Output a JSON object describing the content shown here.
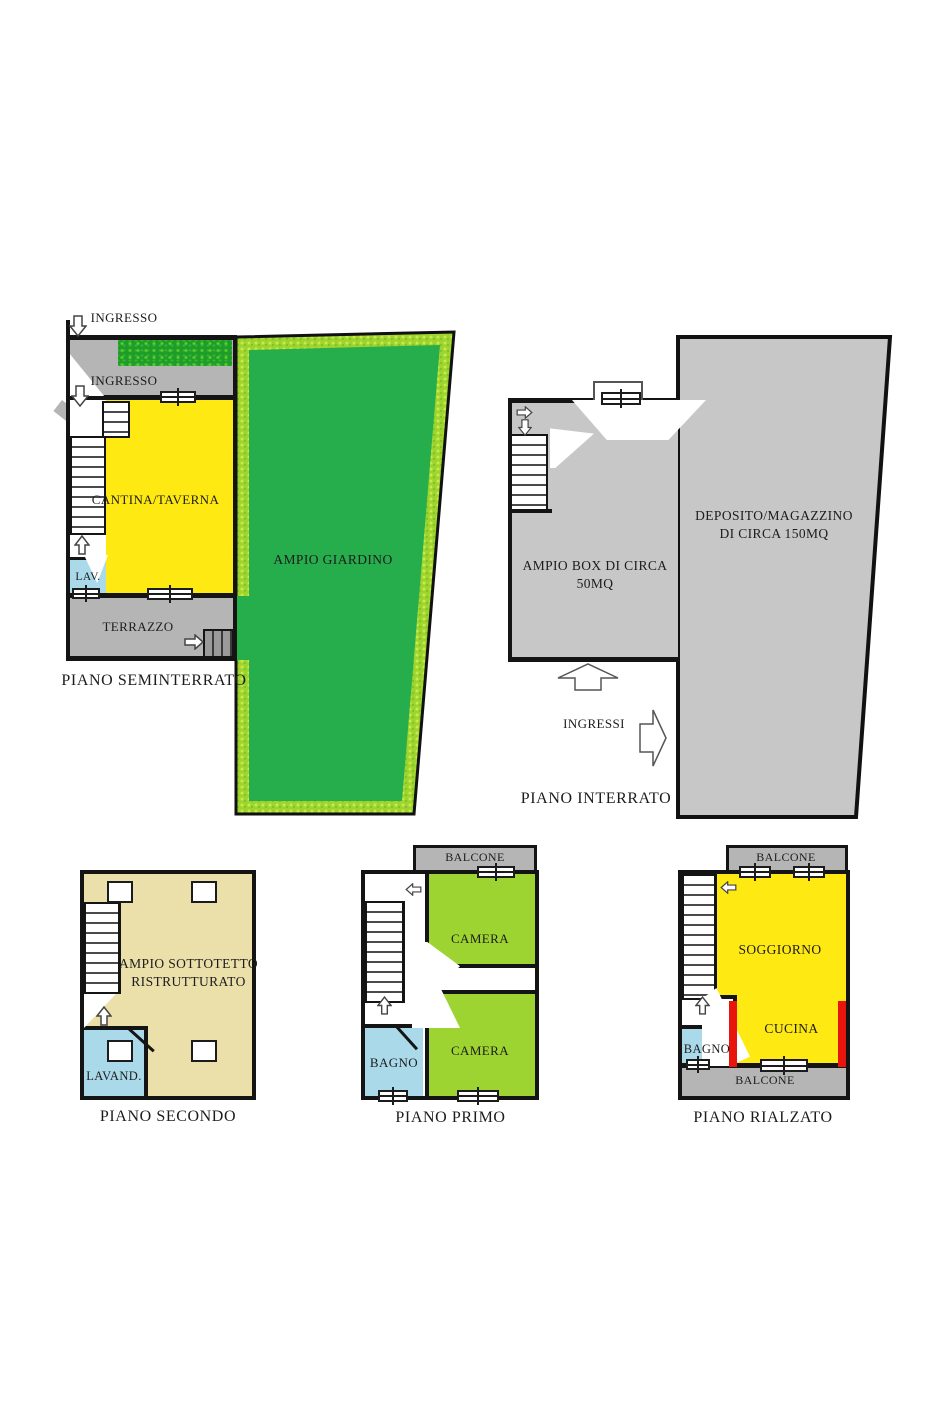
{
  "title": "Planimetria immobile",
  "colors": {
    "wall": "#141414",
    "yellow_room": "#ffe912",
    "green_room": "#9ed431",
    "garden_green": "#26ae4d",
    "garden_border": "#9fd42f",
    "gray_area": "#b5b5b5",
    "storage_gray": "#c7c7c7",
    "blue_room": "#aadae9",
    "tan_room": "#ebdfaa",
    "accent_red": "#e8150d"
  },
  "plans": {
    "seminterrato": {
      "label": "PIANO SEMINTERRATO",
      "ingresso_top": "INGRESSO",
      "ingresso_lower": "INGRESSO",
      "cantina": "CANTINA/TAVERNA",
      "giardino": "AMPIO GIARDINO",
      "lav": "LAV.",
      "terrazzo": "TERRAZZO"
    },
    "interrato": {
      "label": "PIANO INTERRATO",
      "deposito_line1": "DEPOSITO/MAGAZZINO",
      "deposito_line2": "DI CIRCA 150MQ",
      "box": "AMPIO BOX DI CIRCA 50MQ",
      "ingressi": "INGRESSI"
    },
    "secondo": {
      "label": "PIANO SECONDO",
      "sottotetto_line1": "AMPIO SOTTOTETTO",
      "sottotetto_line2": "RISTRUTTURATO",
      "lavanderia": "LAVAND."
    },
    "primo": {
      "label": "PIANO PRIMO",
      "balcone": "BALCONE",
      "camera_upper": "CAMERA",
      "camera_lower": "CAMERA",
      "bagno": "BAGNO"
    },
    "rialzato": {
      "label": "PIANO RIALZATO",
      "balcone_top": "BALCONE",
      "soggiorno": "SOGGIORNO",
      "cucina": "CUCINA",
      "bagno": "BAGNO",
      "balcone_bottom": "BALCONE"
    }
  }
}
